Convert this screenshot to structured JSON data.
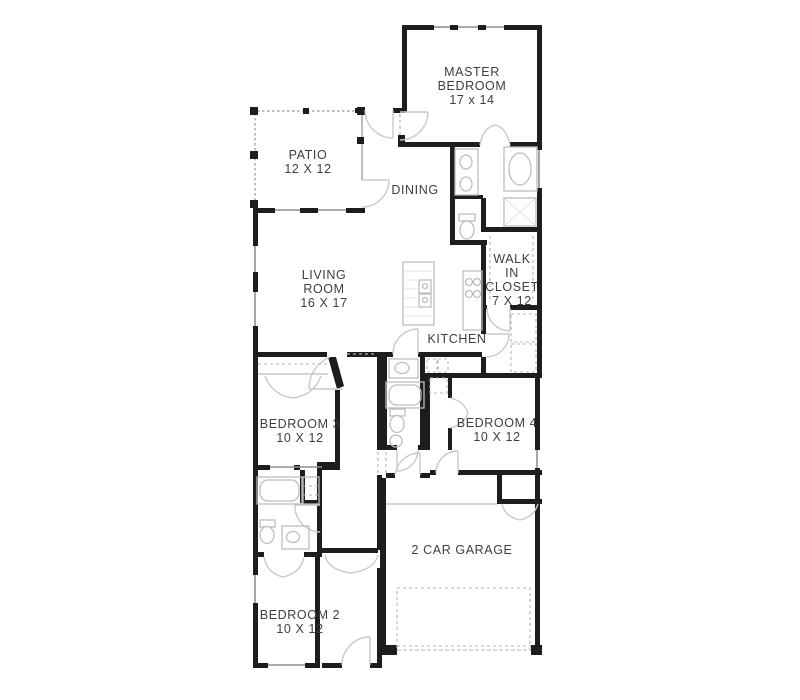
{
  "plan_title": "Single-story house floor plan",
  "rooms": {
    "master_bedroom": {
      "lines": [
        "MASTER",
        "BEDROOM",
        "17 x 14"
      ]
    },
    "patio": {
      "lines": [
        "PATIO",
        "12 X 12"
      ]
    },
    "dining": {
      "lines": [
        "DINING"
      ]
    },
    "living_room": {
      "lines": [
        "LIVING",
        "ROOM",
        "16 X 17"
      ]
    },
    "walk_in_closet": {
      "lines": [
        "WALK",
        "IN",
        "CLOSET",
        "7 X 12"
      ]
    },
    "kitchen": {
      "lines": [
        "KITCHEN"
      ]
    },
    "bedroom_3": {
      "lines": [
        "BEDROOM 3",
        "10 X 12"
      ]
    },
    "bedroom_4": {
      "lines": [
        "BEDROOM 4",
        "10 X 12"
      ]
    },
    "garage": {
      "lines": [
        "2 CAR GARAGE"
      ]
    },
    "bedroom_2": {
      "lines": [
        "BEDROOM 2",
        "10 X 12"
      ]
    }
  },
  "colors": {
    "wall": "#1d1d1d",
    "window": "#8f8f8f",
    "door_swing": "#c9c9c9",
    "fixture": "#bdbdbd",
    "text": "#3e3e3e",
    "background": "#ffffff"
  }
}
